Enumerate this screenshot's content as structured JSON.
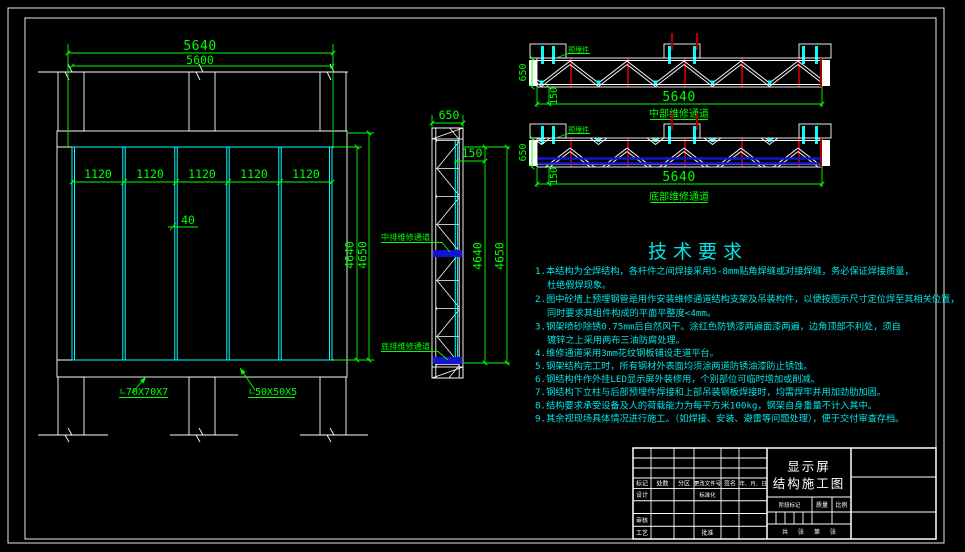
{
  "drawing": {
    "front_view": {
      "dim_width_outer": "5640",
      "dim_width_inner": "5600",
      "panel_widths": [
        "1120",
        "1120",
        "1120",
        "1120",
        "1120"
      ],
      "dim_panel_gap": "40",
      "dim_height_inner": "4640",
      "dim_height_outer": "4650",
      "label_main_angle": "∟70X70X7",
      "label_sub_angle": "∟50X50X5"
    },
    "side_view": {
      "dim_depth": "650",
      "dim_offset": "150",
      "dim_height_inner": "4640",
      "dim_height_outer": "4650",
      "label_mid_walkway": "中排维修通道",
      "label_bottom_walkway": "底排维修通道"
    },
    "truss_mid": {
      "dim_depth": "650",
      "dim_offset": "150",
      "dim_length": "5640",
      "caption": "中部维修通道",
      "embed_label": "预埋件"
    },
    "truss_bottom": {
      "dim_depth": "650",
      "dim_offset": "150",
      "dim_length": "5640",
      "caption": "底部维修通道",
      "embed_label": "预埋件"
    },
    "tech_notes": {
      "title": "技术要求",
      "lines": [
        "1.本结构为全焊结构，各杆件之间焊接采用5-8mm贴角焊缝或对接焊缝，务必保证焊接质量，",
        "杜绝假焊现象。",
        "2.图中砼墙上预埋钢管是用作安装维修通道结构支架及吊装构件，以便按图示尺寸定位焊至其相关位置，",
        "同时要求其组件构成的平面平整度<4mm。",
        "3.钢架喷砂除锈0.75mm后自然风干。涂红色防锈漆两遍面漆两遍，边角顶部不利处，须自",
        "镀锌之上采用两布三油防腐处理。",
        "4.维修通道采用3mm花纹钢板铺设走道平台。",
        "5.钢架结构完工时，所有钢材外表面均须涂两道防锈油漆防止锈蚀。",
        "6.钢结构件作外挂LED显示屏外装修用，个别部位可临时增加或削减。",
        "7.钢结构下立柱与后部预埋件焊接和上部吊装钢板焊接时，均需焊牢并用加劲肋加固。",
        "8.结构要求承受设备及人的荷载能力为每平方米100kg，钢架自身重量不计入其中。",
        "9.其余视现场具体情况进行施工。（如焊接、安装、避雷等问题处理），便于交付审查存档。"
      ]
    },
    "title_block": {
      "title_line1": "显示屏",
      "title_line2": "结构施工图",
      "rev_headers": [
        "标记",
        "处数",
        "分区",
        "更改文件号",
        "签名",
        "年、月、日"
      ],
      "design": "设计",
      "standardization": "标准化",
      "check": "审核",
      "process": "工艺",
      "approve": "批准",
      "stage_mark": "阶段标记",
      "weight": "质量",
      "scale": "比例",
      "sheet": [
        "共",
        "张",
        "第",
        "张"
      ]
    },
    "colors": {
      "background": "#000000",
      "dimension_green": "#00ff00",
      "panel_cyan": "#00ffff",
      "notes_cyan": "#00e6e6",
      "truss_red": "#a80000",
      "walkway_blue": "#1414cc",
      "line_white": "#ffffff"
    }
  }
}
